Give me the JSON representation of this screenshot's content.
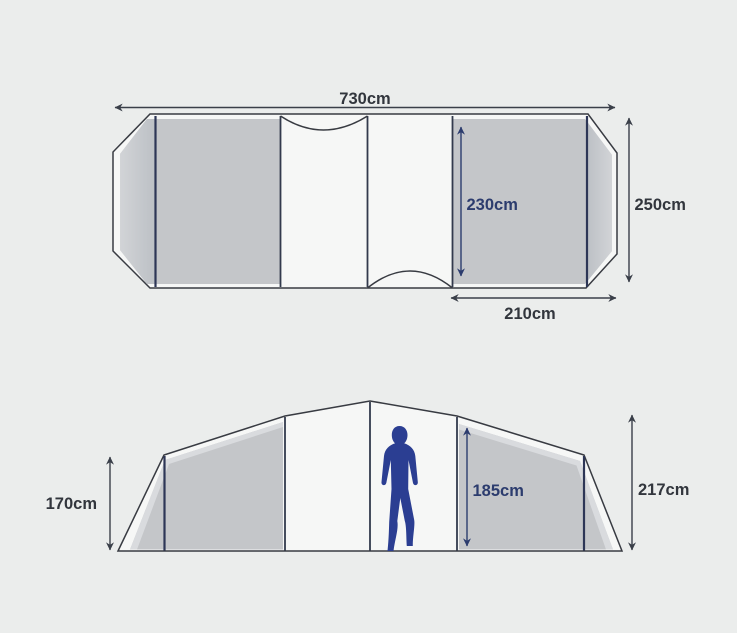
{
  "page": {
    "description": "Tent dimensions diagram with top-down floor plan and side elevation",
    "background_color": "#ebedec"
  },
  "colors": {
    "panel_gray": "#c4c6c9",
    "bevel_light": "#d9dbde",
    "outline_dark": "#383b42",
    "divider_navy": "#2d3656",
    "dim_dark": "#32363d",
    "dim_navy": "#2c3c6e",
    "person_blue": "#2b3e92",
    "tent_shell_white": "#f6f7f6"
  },
  "floor_plan": {
    "view": "top",
    "dims": {
      "total_width": {
        "label": "730cm",
        "value_cm": 730
      },
      "total_depth": {
        "label": "250cm",
        "value_cm": 250
      },
      "bedroom_depth": {
        "label": "230cm",
        "value_cm": 230
      },
      "bedroom_width": {
        "label": "210cm",
        "value_cm": 210
      }
    }
  },
  "side_view": {
    "view": "side elevation",
    "dims": {
      "wall_height": {
        "label": "170cm",
        "value_cm": 170
      },
      "interior_height": {
        "label": "185cm",
        "value_cm": 185
      },
      "peak_height": {
        "label": "217cm",
        "value_cm": 217
      }
    },
    "person": {
      "description": "adult human silhouette for scale"
    }
  }
}
